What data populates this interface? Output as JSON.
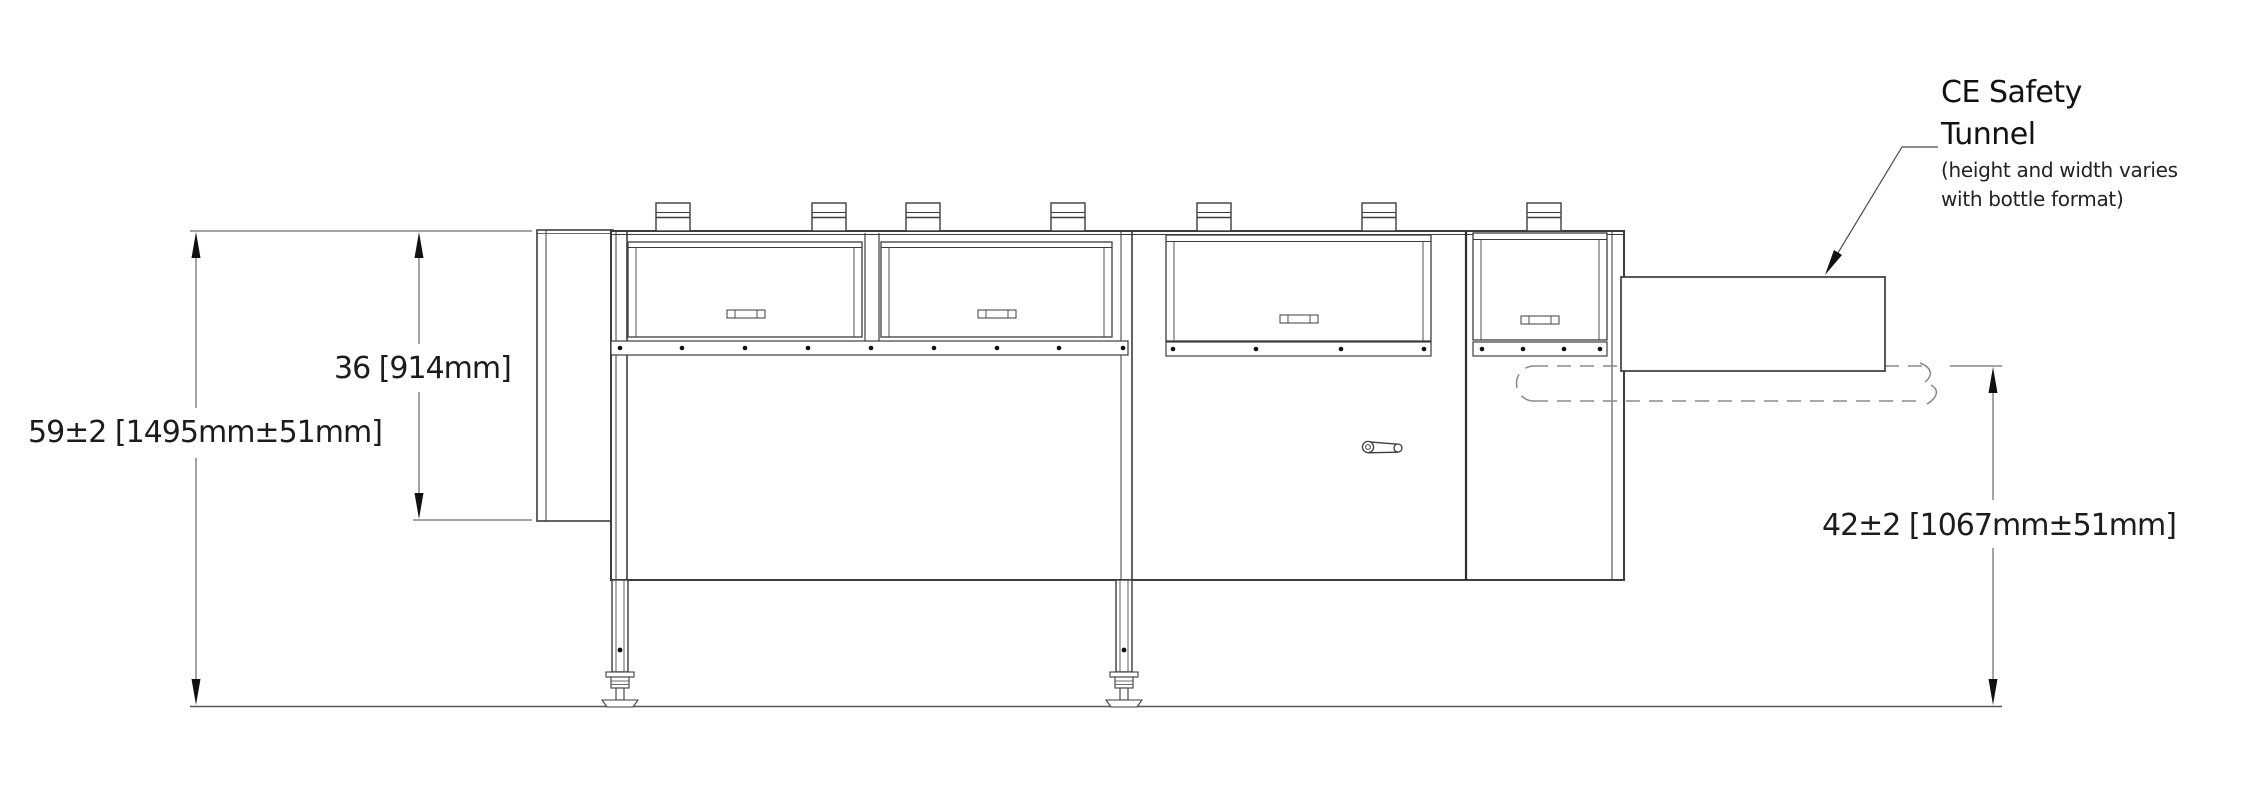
{
  "drawing": {
    "dimensions": {
      "overall_height_label": "59±2 [1495mm±51mm]",
      "enclosure_height_label": "36 [914mm]",
      "conveyor_height_label": "42±2 [1067mm±51mm]"
    },
    "callout": {
      "title_line1": "CE Safety",
      "title_line2": "Tunnel",
      "note_line1": "(height and width varies",
      "note_line2": "with bottle format)"
    },
    "colors": {
      "line": "#3d3d3d",
      "dim_line": "#4a4a4a",
      "dashed": "#8a8a8a",
      "text": "#1c1c1c"
    }
  }
}
